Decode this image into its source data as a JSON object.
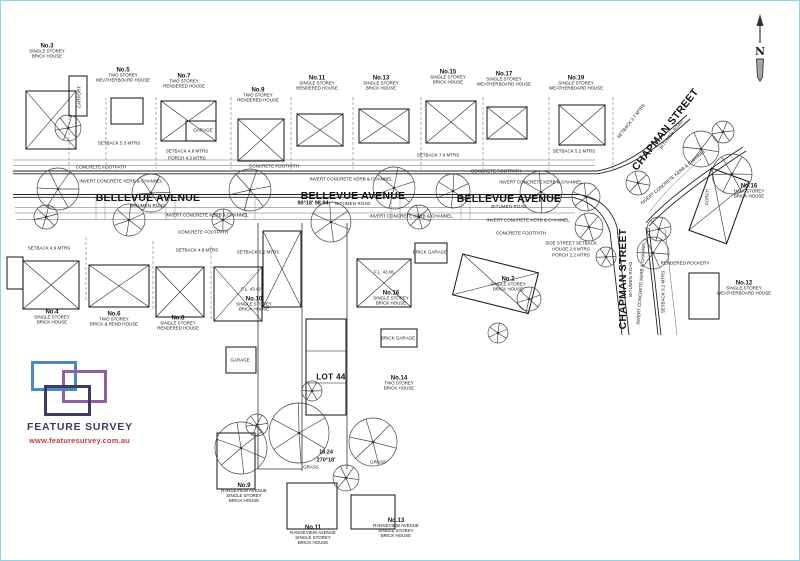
{
  "page": {
    "background": "#ffffff",
    "scan_border_color": "#8ed5e5",
    "ink_color": "#1d1d1d"
  },
  "north": {
    "label": "N"
  },
  "logo": {
    "title": "FEATURE SURVEY",
    "url": "www.featuresurvey.com.au",
    "colors": {
      "blue": "#4e86c6",
      "purple": "#8f5fa8",
      "navy": "#3c3c60",
      "title": "#3c3c60",
      "url": "#c43b4e"
    }
  },
  "streets": [
    {
      "name": "BELLEVUE AVENUE",
      "sub": "BITUMEN ROAD",
      "x": 147,
      "y": 199,
      "rot": 0
    },
    {
      "name": "BELLEVUE AVENUE",
      "sub": "BITUMEN ROAD",
      "x": 352,
      "y": 197,
      "rot": 0
    },
    {
      "name": "BELLEVUE AVENUE",
      "sub": "BITUMEN ROAD",
      "x": 508,
      "y": 200,
      "rot": 0
    },
    {
      "name": "CHAPMAN STREET",
      "sub": "BITUMEN ROAD",
      "x": 666,
      "y": 130,
      "rot": -52
    },
    {
      "name": "CHAPMAN STREET",
      "sub": "BITUMEN ROAD",
      "x": 624,
      "y": 278,
      "rot": -90
    }
  ],
  "lots": [
    {
      "no": "No.3",
      "lines": [
        "SINGLE STOREY",
        "BRICK HOUSE"
      ],
      "x": 46,
      "y": 50
    },
    {
      "no": "No.5",
      "lines": [
        "TWO STOREY",
        "WEATHERBOARD HOUSE"
      ],
      "x": 122,
      "y": 74
    },
    {
      "no": "No.7",
      "lines": [
        "TWO STOREY",
        "RENDERED HOUSE"
      ],
      "x": 183,
      "y": 80
    },
    {
      "no": "No.9",
      "lines": [
        "TWO STOREY",
        "RENDERED HOUSE"
      ],
      "x": 257,
      "y": 94
    },
    {
      "no": "No.11",
      "lines": [
        "SINGLE STOREY",
        "RENDERED HOUSE"
      ],
      "x": 316,
      "y": 82
    },
    {
      "no": "No.13",
      "lines": [
        "SINGLE STOREY",
        "BRICK HOUSE"
      ],
      "x": 380,
      "y": 82
    },
    {
      "no": "No.15",
      "lines": [
        "SINGLE STOREY",
        "BRICK HOUSE"
      ],
      "x": 447,
      "y": 76
    },
    {
      "no": "No.17",
      "lines": [
        "SINGLE STOREY",
        "WEATHERBOARD HOUSE"
      ],
      "x": 503,
      "y": 78
    },
    {
      "no": "No.19",
      "lines": [
        "SINGLE STOREY",
        "WEATHERBOARD HOUSE"
      ],
      "x": 575,
      "y": 82
    },
    {
      "no": "No.4",
      "lines": [
        "SINGLE STOREY",
        "BRICK HOUSE"
      ],
      "x": 51,
      "y": 316
    },
    {
      "no": "No.6",
      "lines": [
        "TWO STOREY",
        "BRICK & REND HOUSE"
      ],
      "x": 113,
      "y": 318
    },
    {
      "no": "No.8",
      "lines": [
        "SINGLE STOREY",
        "RENDERED HOUSE"
      ],
      "x": 177,
      "y": 322
    },
    {
      "no": "No.10",
      "lines": [
        "SINGLE STOREY",
        "BRICK HOUSE"
      ],
      "x": 253,
      "y": 303
    },
    {
      "no": "No.16",
      "lines": [
        "SINGLE STOREY",
        "BRICK HOUSE"
      ],
      "x": 390,
      "y": 297
    },
    {
      "no": "No.14",
      "lines": [
        "TWO STOREY",
        "BRICK HOUSE"
      ],
      "x": 398,
      "y": 382
    },
    {
      "no": "No.2",
      "lines": [
        "SINGLE STOREY",
        "BRICK HOUSE"
      ],
      "x": 507,
      "y": 283
    },
    {
      "no": "No.16",
      "lines": [
        "HALF STOREY",
        "BRICK HOUSE"
      ],
      "x": 748,
      "y": 190
    },
    {
      "no": "No.12",
      "lines": [
        "SINGLE STOREY",
        "WEATHERBOARD HOUSE"
      ],
      "x": 743,
      "y": 287
    },
    {
      "no": "LOT 44",
      "lines": [],
      "x": 330,
      "y": 376,
      "big": true
    },
    {
      "no": "No.9",
      "lines": [
        "RANGEVIEW AVENUE",
        "SINGLE STOREY",
        "BRICK HOUSE"
      ],
      "x": 243,
      "y": 492
    },
    {
      "no": "No.11",
      "lines": [
        "RANGEVIEW AVENUE",
        "SINGLE STOREY",
        "BRICK HOUSE"
      ],
      "x": 312,
      "y": 534
    },
    {
      "no": "No.13",
      "lines": [
        "RANGEVIEW AVENUE",
        "SINGLE STOREY",
        "BRICK HOUSE"
      ],
      "x": 395,
      "y": 527
    }
  ],
  "annotations": [
    {
      "text": "CONCRETE FOOTPATH",
      "x": 100,
      "y": 166
    },
    {
      "text": "CONCRETE FOOTPATH",
      "x": 273,
      "y": 165
    },
    {
      "text": "CONCRETE FOOTPATH",
      "x": 495,
      "y": 170
    },
    {
      "text": "CONCRETE FOOTPATH",
      "x": 202,
      "y": 231
    },
    {
      "text": "CONCRETE FOOTPATH",
      "x": 520,
      "y": 232
    },
    {
      "text": "INVERT CONCRETE KERB & CHANNEL",
      "x": 120,
      "y": 180
    },
    {
      "text": "INVERT CONCRETE KERB & CHANNEL",
      "x": 350,
      "y": 178
    },
    {
      "text": "INVERT CONCRETE KERB & CHANNEL",
      "x": 540,
      "y": 181
    },
    {
      "text": "INVERT CONCRETE KERB & CHANNEL",
      "x": 206,
      "y": 214
    },
    {
      "text": "INVERT CONCRETE KERB & CHANNEL",
      "x": 410,
      "y": 215
    },
    {
      "text": "INVERT CONCRETE KERB & CHANNEL",
      "x": 527,
      "y": 219
    },
    {
      "text": "INVERT CONCRETE KERB & CHANNEL",
      "x": 672,
      "y": 176,
      "rot": -40
    },
    {
      "text": "INVERT CONCRETE KERB & CHANNEL",
      "x": 640,
      "y": 282,
      "rot": -86
    },
    {
      "text": "90°18'  98.94",
      "x": 312,
      "y": 202,
      "b": true
    },
    {
      "text": "18.24",
      "x": 325,
      "y": 451,
      "b": true
    },
    {
      "text": "270°18'",
      "x": 325,
      "y": 459,
      "b": true
    },
    {
      "text": "GRASS",
      "x": 310,
      "y": 466
    },
    {
      "text": "GRASS",
      "x": 377,
      "y": 461
    },
    {
      "text": "GARAGE",
      "x": 202,
      "y": 129
    },
    {
      "text": "GARAGE",
      "x": 239,
      "y": 359
    },
    {
      "text": "BRICK GARAGE",
      "x": 429,
      "y": 251
    },
    {
      "text": "BRICK GARAGE",
      "x": 397,
      "y": 337
    },
    {
      "text": "CARPORT",
      "x": 78,
      "y": 96,
      "rot": -90
    },
    {
      "text": "SETBACK 5.3 MTRS",
      "x": 118,
      "y": 142
    },
    {
      "text": "SETBACK 4.9 MTRS",
      "x": 186,
      "y": 150
    },
    {
      "text": "PORCH 4.3 MTRS",
      "x": 186,
      "y": 157
    },
    {
      "text": "SETBACK 7.4 MTRS",
      "x": 437,
      "y": 154
    },
    {
      "text": "SETBACK 5.2 MTRS",
      "x": 573,
      "y": 150
    },
    {
      "text": "SETBACK 4.8 MTRS",
      "x": 196,
      "y": 249
    },
    {
      "text": "SETBACK 5.2 MTRS",
      "x": 257,
      "y": 251
    },
    {
      "text": "SETBACK 4.9 MTRS",
      "x": 48,
      "y": 247
    },
    {
      "text": "SIDE STREET SETBACK",
      "x": 570,
      "y": 242
    },
    {
      "text": "HOUSE 2.8 MTRS",
      "x": 570,
      "y": 248
    },
    {
      "text": "PORCH 2.2 MTRS",
      "x": 570,
      "y": 254
    },
    {
      "text": "SETBACK 3.2 MTRS",
      "x": 662,
      "y": 291,
      "rot": -90
    },
    {
      "text": "RENDERED ROCKERY",
      "x": 684,
      "y": 262
    },
    {
      "text": "F.L. 43.42",
      "x": 250,
      "y": 288
    },
    {
      "text": "F.L. 43.06",
      "x": 383,
      "y": 271
    },
    {
      "text": "SETBACK 2.7 MTRS",
      "x": 630,
      "y": 120,
      "rot": -52
    },
    {
      "text": "PORCH",
      "x": 706,
      "y": 196,
      "rot": -90
    }
  ]
}
